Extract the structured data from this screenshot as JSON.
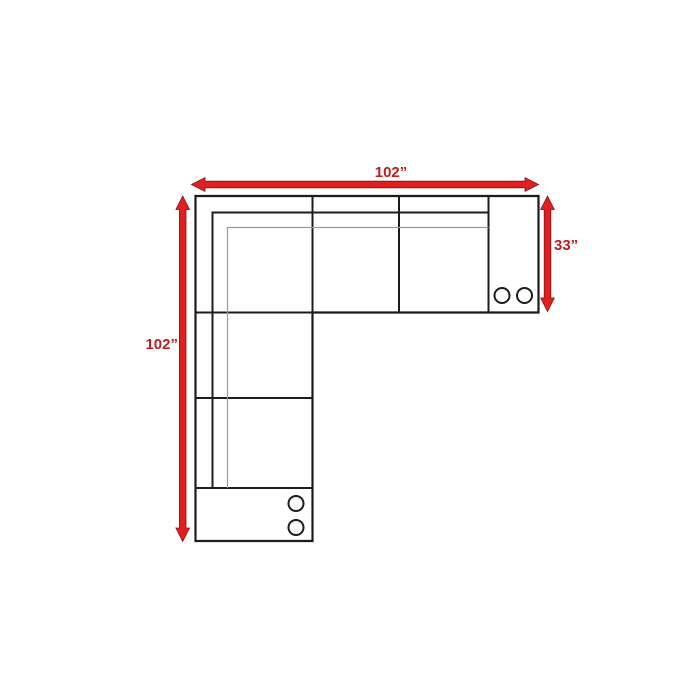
{
  "diagram": {
    "labels": {
      "top_width": "102”",
      "left_height": "102”",
      "right_depth": "33”"
    },
    "colors": {
      "arrow_red": "#e02020",
      "dimension_text_red": "#bc1f1f",
      "sofa_outline": "#1c1c1c",
      "cushion_line_gray": "#9b9b9b",
      "background": "#ffffff"
    }
  }
}
